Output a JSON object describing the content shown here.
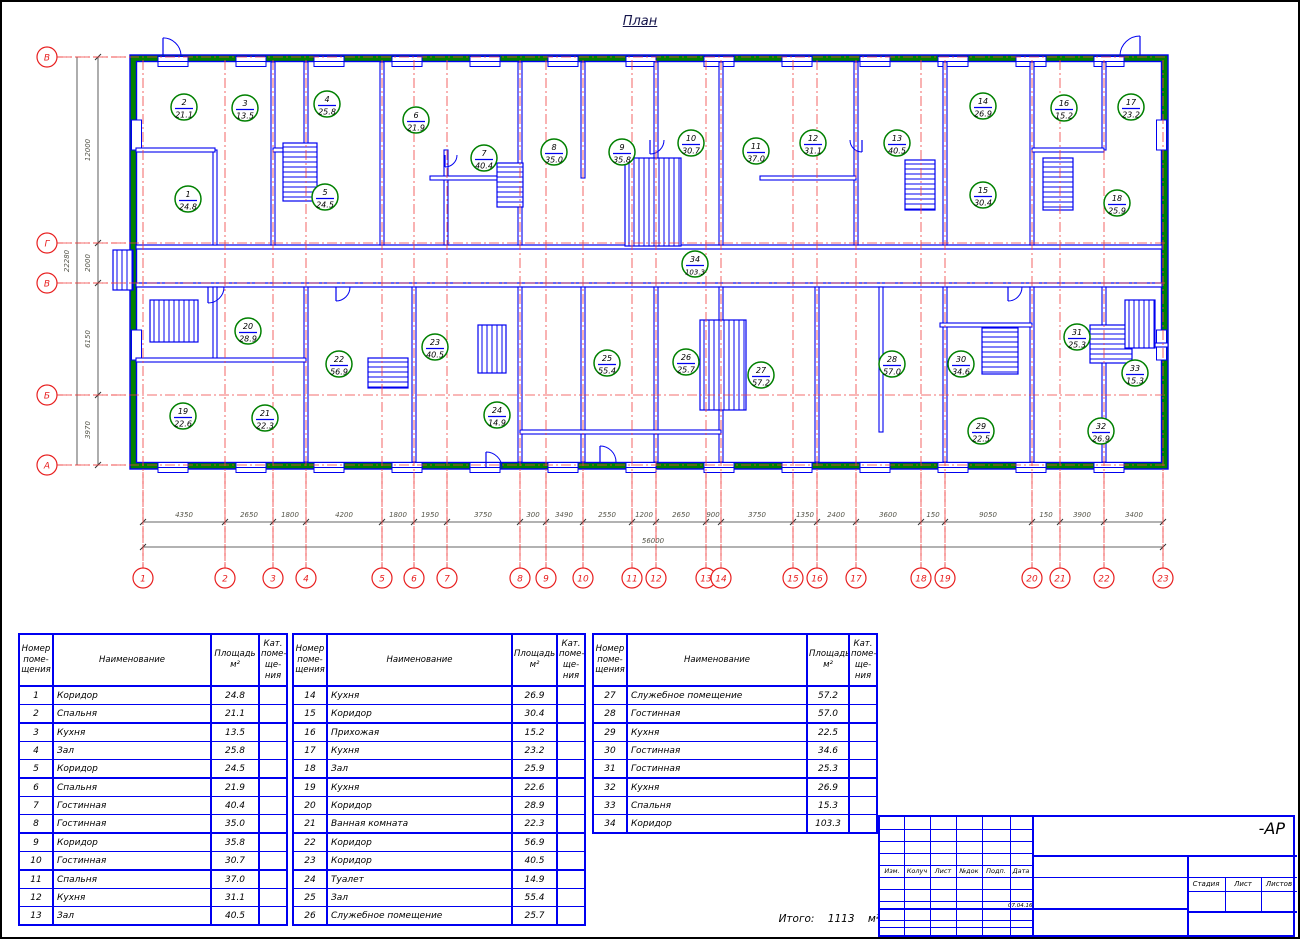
{
  "colors": {
    "blue": "#0000f0",
    "green": "#008000",
    "red": "#e82020",
    "axis_red": "#f04040",
    "dim": "#55554a",
    "ink": "#000000",
    "title_ink": "#14144a"
  },
  "plan": {
    "title": "План",
    "rooms": [
      {
        "n": "1",
        "area": "24.8",
        "x": 188,
        "y": 199
      },
      {
        "n": "2",
        "area": "21.1",
        "x": 184,
        "y": 107
      },
      {
        "n": "3",
        "area": "13.5",
        "x": 245,
        "y": 108
      },
      {
        "n": "4",
        "area": "25.8",
        "x": 327,
        "y": 104
      },
      {
        "n": "5",
        "area": "24.5",
        "x": 325,
        "y": 197
      },
      {
        "n": "6",
        "area": "21.9",
        "x": 416,
        "y": 120
      },
      {
        "n": "7",
        "area": "40.4",
        "x": 484,
        "y": 158
      },
      {
        "n": "8",
        "area": "35.0",
        "x": 554,
        "y": 152
      },
      {
        "n": "9",
        "area": "35.8",
        "x": 622,
        "y": 152
      },
      {
        "n": "10",
        "area": "30.7",
        "x": 691,
        "y": 143
      },
      {
        "n": "11",
        "area": "37.0",
        "x": 756,
        "y": 151
      },
      {
        "n": "12",
        "area": "31.1",
        "x": 813,
        "y": 143
      },
      {
        "n": "13",
        "area": "40.5",
        "x": 897,
        "y": 143
      },
      {
        "n": "14",
        "area": "26.9",
        "x": 983,
        "y": 106
      },
      {
        "n": "15",
        "area": "30.4",
        "x": 983,
        "y": 195
      },
      {
        "n": "16",
        "area": "15.2",
        "x": 1064,
        "y": 108
      },
      {
        "n": "17",
        "area": "23.2",
        "x": 1131,
        "y": 107
      },
      {
        "n": "18",
        "area": "25.9",
        "x": 1117,
        "y": 203
      },
      {
        "n": "19",
        "area": "22.6",
        "x": 183,
        "y": 416
      },
      {
        "n": "20",
        "area": "28.9",
        "x": 248,
        "y": 331
      },
      {
        "n": "21",
        "area": "22.3",
        "x": 265,
        "y": 418
      },
      {
        "n": "22",
        "area": "56.9",
        "x": 339,
        "y": 364
      },
      {
        "n": "23",
        "area": "40.5",
        "x": 435,
        "y": 347
      },
      {
        "n": "24",
        "area": "14.9",
        "x": 497,
        "y": 415
      },
      {
        "n": "25",
        "area": "55.4",
        "x": 607,
        "y": 363
      },
      {
        "n": "26",
        "area": "25.7",
        "x": 686,
        "y": 362
      },
      {
        "n": "27",
        "area": "57.2",
        "x": 761,
        "y": 375
      },
      {
        "n": "28",
        "area": "57.0",
        "x": 892,
        "y": 364
      },
      {
        "n": "29",
        "area": "22.5",
        "x": 981,
        "y": 431
      },
      {
        "n": "30",
        "area": "34.6",
        "x": 961,
        "y": 364
      },
      {
        "n": "31",
        "area": "25.3",
        "x": 1077,
        "y": 337
      },
      {
        "n": "32",
        "area": "26.9",
        "x": 1101,
        "y": 431
      },
      {
        "n": "33",
        "area": "15.3",
        "x": 1135,
        "y": 373
      },
      {
        "n": "34",
        "area": "103.3",
        "x": 695,
        "y": 264
      }
    ],
    "row_axes": [
      {
        "label": "В",
        "y": 57
      },
      {
        "label": "Г",
        "y": 243
      },
      {
        "label": "В",
        "y": 283
      },
      {
        "label": "Б",
        "y": 395
      },
      {
        "label": "А",
        "y": 465
      }
    ],
    "col_axes": [
      {
        "label": "1",
        "x": 143
      },
      {
        "label": "2",
        "x": 225
      },
      {
        "label": "3",
        "x": 273
      },
      {
        "label": "4",
        "x": 306
      },
      {
        "label": "5",
        "x": 382
      },
      {
        "label": "6",
        "x": 414
      },
      {
        "label": "7",
        "x": 447
      },
      {
        "label": "8",
        "x": 520
      },
      {
        "label": "9",
        "x": 546
      },
      {
        "label": "10",
        "x": 583
      },
      {
        "label": "11",
        "x": 632
      },
      {
        "label": "12",
        "x": 656
      },
      {
        "label": "13",
        "x": 706
      },
      {
        "label": "14",
        "x": 721
      },
      {
        "label": "15",
        "x": 793
      },
      {
        "label": "16",
        "x": 817
      },
      {
        "label": "17",
        "x": 856
      },
      {
        "label": "18",
        "x": 921
      },
      {
        "label": "19",
        "x": 945
      },
      {
        "label": "20",
        "x": 1032
      },
      {
        "label": "21",
        "x": 1060
      },
      {
        "label": "22",
        "x": 1104
      },
      {
        "label": "23",
        "x": 1163
      }
    ],
    "dims_bottom": {
      "labels": [
        {
          "t": "4350",
          "x": 184
        },
        {
          "t": "2650",
          "x": 249
        },
        {
          "t": "1800",
          "x": 290
        },
        {
          "t": "4200",
          "x": 344
        },
        {
          "t": "1800",
          "x": 398
        },
        {
          "t": "1950",
          "x": 430
        },
        {
          "t": "3750",
          "x": 483
        },
        {
          "t": "300",
          "x": 533
        },
        {
          "t": "3490",
          "x": 564
        },
        {
          "t": "2550",
          "x": 607
        },
        {
          "t": "1200",
          "x": 644
        },
        {
          "t": "2650",
          "x": 681
        },
        {
          "t": "900",
          "x": 713
        },
        {
          "t": "3750",
          "x": 757
        },
        {
          "t": "1350",
          "x": 805
        },
        {
          "t": "2400",
          "x": 836
        },
        {
          "t": "3600",
          "x": 888
        },
        {
          "t": "150",
          "x": 933
        },
        {
          "t": "9050",
          "x": 988
        },
        {
          "t": "150",
          "x": 1046
        },
        {
          "t": "3900",
          "x": 1082
        },
        {
          "t": "3400",
          "x": 1134
        }
      ],
      "total": "56000"
    },
    "dims_left": {
      "labels": [
        {
          "t": "12000",
          "y": 150
        },
        {
          "t": "2000",
          "y": 263
        },
        {
          "t": "6150",
          "y": 339
        },
        {
          "t": "3970",
          "y": 430
        }
      ],
      "total": "22280"
    }
  },
  "tables": [
    {
      "headers": [
        "Номер\nпоме-\nщения",
        "Наименование",
        "Площадь\nм²",
        "Кат.\nпоме-\nще-\nния"
      ],
      "col_widths": [
        34,
        158,
        48,
        28
      ],
      "thick_after": [
        2,
        5,
        8,
        10
      ],
      "rows": [
        [
          "1",
          "Коридор",
          "24.8",
          ""
        ],
        [
          "2",
          "Спальня",
          "21.1",
          ""
        ],
        [
          "3",
          "Кухня",
          "13.5",
          ""
        ],
        [
          "4",
          "Зал",
          "25.8",
          ""
        ],
        [
          "5",
          "Коридор",
          "24.5",
          ""
        ],
        [
          "6",
          "Спальня",
          "21.9",
          ""
        ],
        [
          "7",
          "Гостинная",
          "40.4",
          ""
        ],
        [
          "8",
          "Гостинная",
          "35.0",
          ""
        ],
        [
          "9",
          "Коридор",
          "35.8",
          ""
        ],
        [
          "10",
          "Гостинная",
          "30.7",
          ""
        ],
        [
          "11",
          "Спальня",
          "37.0",
          ""
        ],
        [
          "12",
          "Кухня",
          "31.1",
          ""
        ],
        [
          "13",
          "Зал",
          "40.5",
          ""
        ]
      ]
    },
    {
      "headers": [
        "Номер\nпоме-\nщения",
        "Наименование",
        "Площадь\nм²",
        "Кат.\nпоме-\nще-\nния"
      ],
      "col_widths": [
        34,
        185,
        45,
        28
      ],
      "thick_after": [
        2,
        5,
        8,
        10
      ],
      "rows": [
        [
          "14",
          "Кухня",
          "26.9",
          ""
        ],
        [
          "15",
          "Коридор",
          "30.4",
          ""
        ],
        [
          "16",
          "Прихожая",
          "15.2",
          ""
        ],
        [
          "17",
          "Кухня",
          "23.2",
          ""
        ],
        [
          "18",
          "Зал",
          "25.9",
          ""
        ],
        [
          "19",
          "Кухня",
          "22.6",
          ""
        ],
        [
          "20",
          "Коридор",
          "28.9",
          ""
        ],
        [
          "21",
          "Ванная комната",
          "22.3",
          ""
        ],
        [
          "22",
          "Коридор",
          "56.9",
          ""
        ],
        [
          "23",
          "Коридор",
          "40.5",
          ""
        ],
        [
          "24",
          "Туалет",
          "14.9",
          ""
        ],
        [
          "25",
          "Зал",
          "55.4",
          ""
        ],
        [
          "26",
          "Служебное помещение",
          "25.7",
          ""
        ]
      ]
    },
    {
      "headers": [
        "Номер\nпоме-\nщения",
        "Наименование",
        "Площадь\nм²",
        "Кат.\nпоме-\nще-\nния"
      ],
      "col_widths": [
        34,
        180,
        42,
        28
      ],
      "thick_after": [
        2,
        5
      ],
      "rows": [
        [
          "27",
          "Служебное помещение",
          "57.2",
          ""
        ],
        [
          "28",
          "Гостинная",
          "57.0",
          ""
        ],
        [
          "29",
          "Кухня",
          "22.5",
          ""
        ],
        [
          "30",
          "Гостинная",
          "34.6",
          ""
        ],
        [
          "31",
          "Гостинная",
          "25.3",
          ""
        ],
        [
          "32",
          "Кухня",
          "26.9",
          ""
        ],
        [
          "33",
          "Спальня",
          "15.3",
          ""
        ],
        [
          "34",
          "Коридор",
          "103.3",
          ""
        ]
      ]
    }
  ],
  "total": {
    "label": "Итого:",
    "value": "1113",
    "unit": "м²"
  },
  "stamp": {
    "doc_code": "-АР",
    "header_cells": [
      "Изм.",
      "Колуч",
      "Лист",
      "№док",
      "Подп.",
      "Дата"
    ],
    "right_cells": [
      "Стадия",
      "Лист",
      "Листов"
    ],
    "date": "07.04.16"
  }
}
